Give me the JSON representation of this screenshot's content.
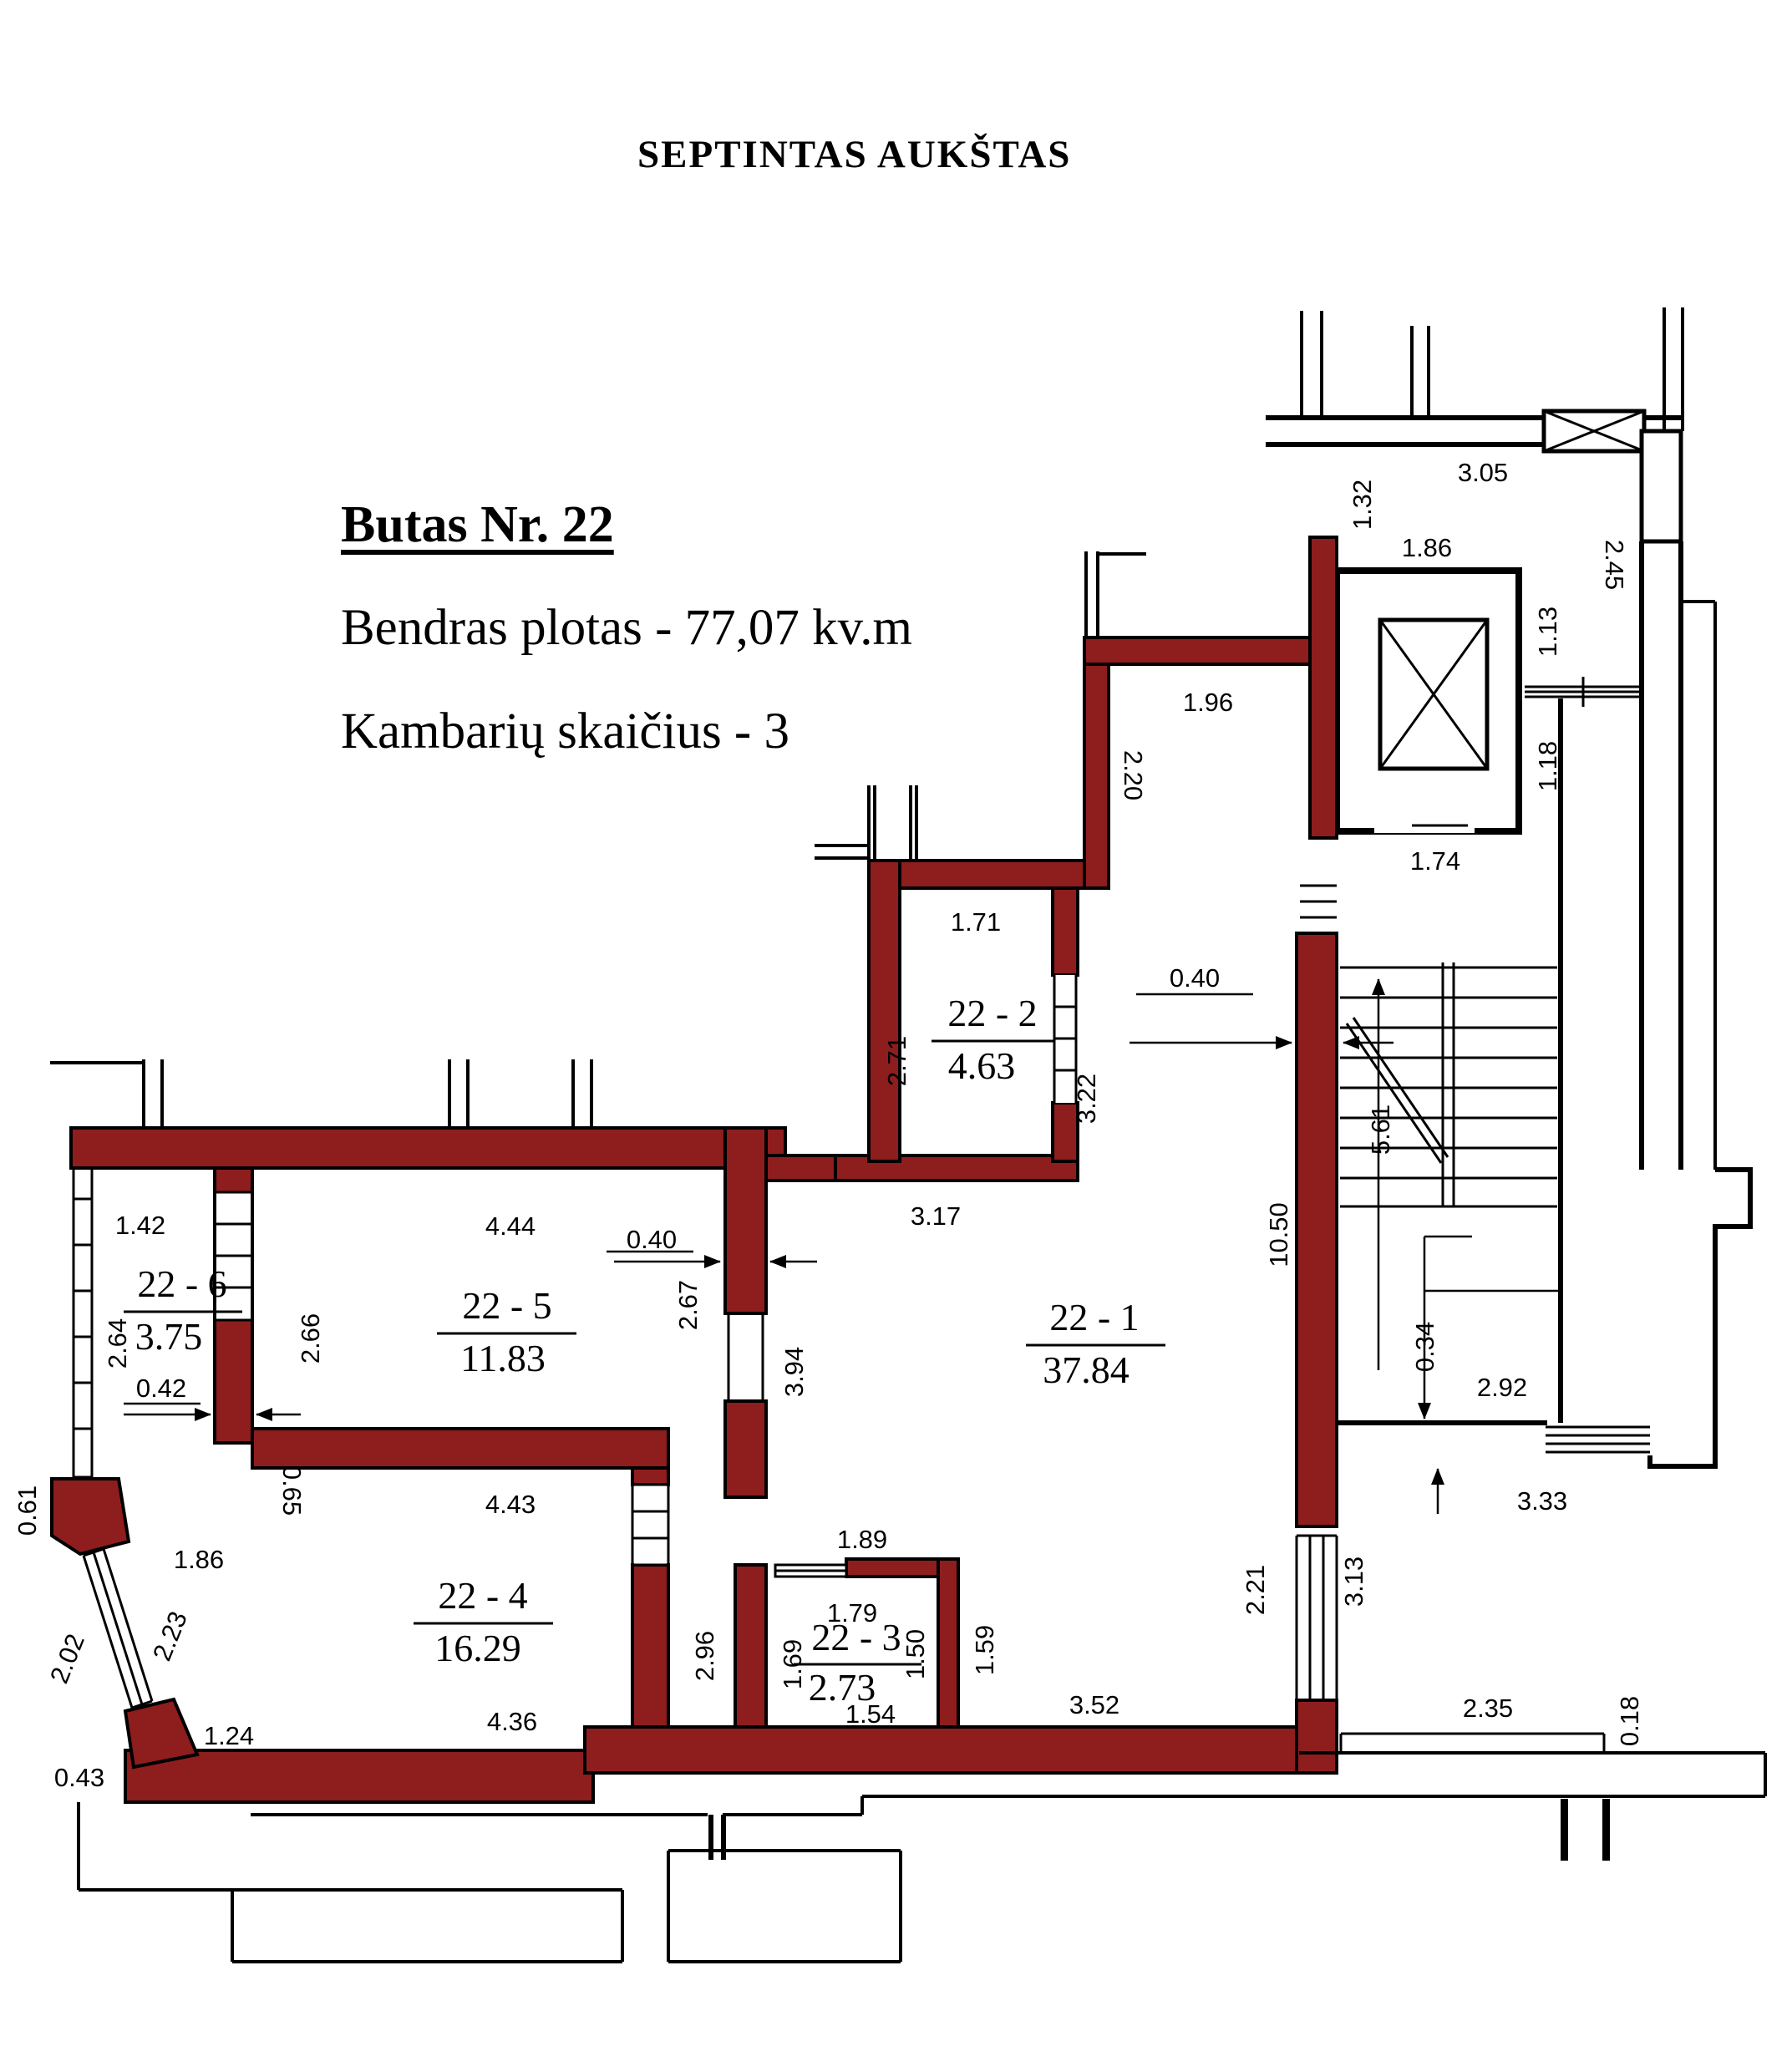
{
  "title": "SEPTINTAS AUKŠTAS",
  "info": {
    "line1": "Butas Nr. 22",
    "line2": "Bendras plotas - 77,07 kv.m",
    "line3": "Kambarių skaičius - 3"
  },
  "colors": {
    "wall": "#8e1d1d",
    "line": "#000000",
    "background": "#ffffff"
  },
  "rooms": {
    "r1": {
      "label": "22 - 1",
      "area": "37.84"
    },
    "r2": {
      "label": "22 - 2",
      "area": "4.63"
    },
    "r3": {
      "label": "22 - 3",
      "area": "2.73"
    },
    "r4": {
      "label": "22 - 4",
      "area": "16.29"
    },
    "r5": {
      "label": "22 - 5",
      "area": "11.83"
    },
    "r6": {
      "label": "22 - 6",
      "area": "3.75"
    }
  },
  "dims": {
    "t305": "3.05",
    "t132": "1.32",
    "t186a": "1.86",
    "t245": "2.45",
    "t113": "1.13",
    "t118": "1.18",
    "t174": "1.74",
    "t196": "1.96",
    "t220": "2.20",
    "t040a": "0.40",
    "t561": "5.61",
    "t1050": "10.50",
    "t034": "0.34",
    "t292": "2.92",
    "t333": "3.33",
    "t171": "1.71",
    "t271": "2.71",
    "t322": "3.22",
    "t317": "3.17",
    "t142": "1.42",
    "t264": "2.64",
    "t042": "0.42",
    "t266": "2.66",
    "t444": "4.44",
    "t267": "2.67",
    "t040b": "0.40",
    "t394": "3.94",
    "t443": "4.43",
    "t296": "2.96",
    "t436": "4.36",
    "t065": "0.65",
    "t061": "0.61",
    "t186b": "1.86",
    "t202": "2.02",
    "t223": "2.23",
    "t124": "1.24",
    "t043": "0.43",
    "t189": "1.89",
    "t179": "1.79",
    "t169": "1.69",
    "t150": "1.50",
    "t154": "1.54",
    "t159": "1.59",
    "t352": "3.52",
    "t221": "2.21",
    "t313": "3.13",
    "t235": "2.35",
    "t018": "0.18"
  }
}
